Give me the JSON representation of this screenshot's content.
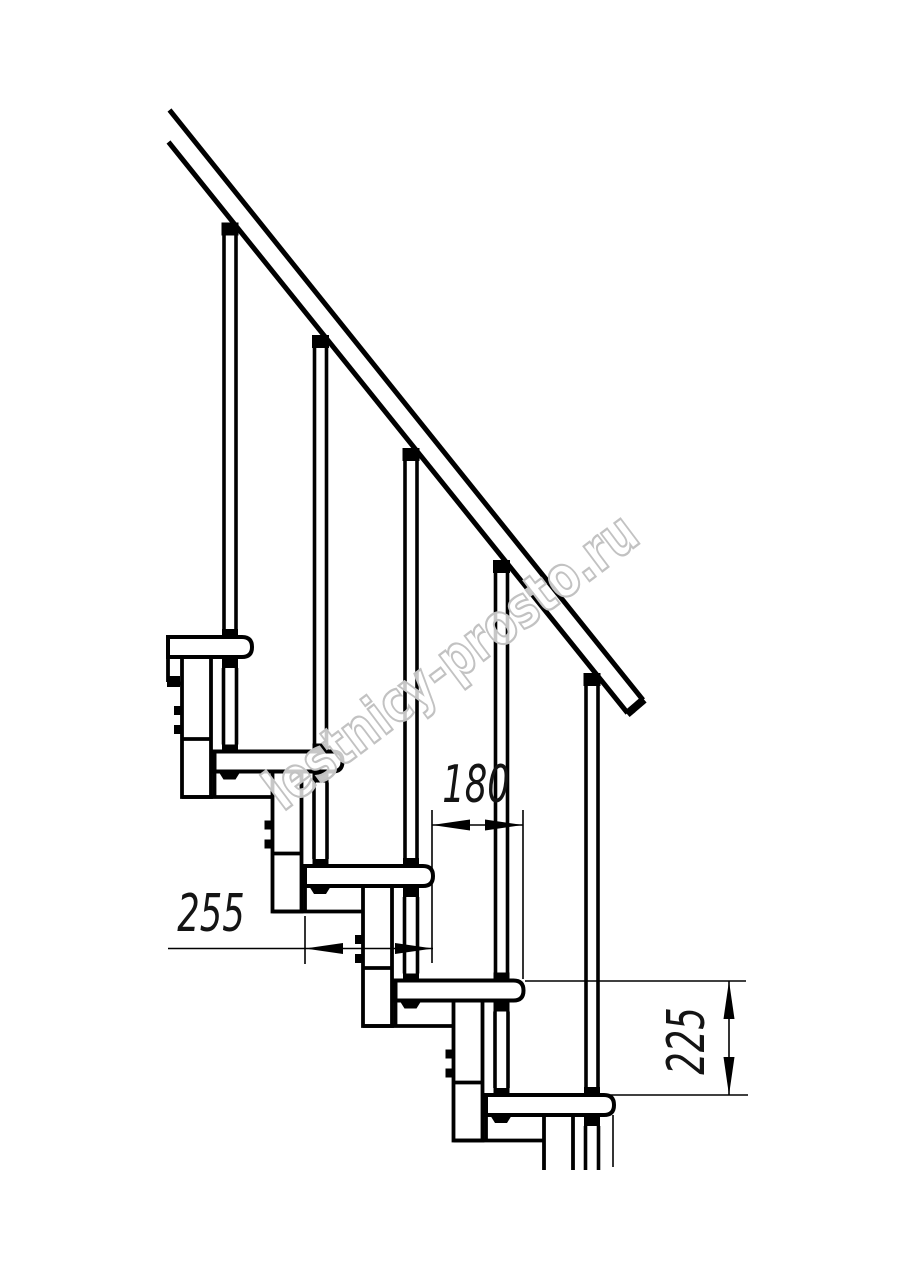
{
  "drawing": {
    "description": "Side-section technical drawing of a modular staircase with handrail",
    "visible_steps": 5,
    "visible_balusters": 5,
    "dimensions": {
      "step_run_label": "180",
      "tread_depth_label": "255",
      "step_rise_label": "225"
    },
    "watermark": {
      "text": "lestnicy-prosto.ru"
    },
    "colors": {
      "line": "#000000",
      "background": "#ffffff",
      "watermark_outline": "#c2c2c2",
      "dimension_text": "#141414"
    }
  }
}
